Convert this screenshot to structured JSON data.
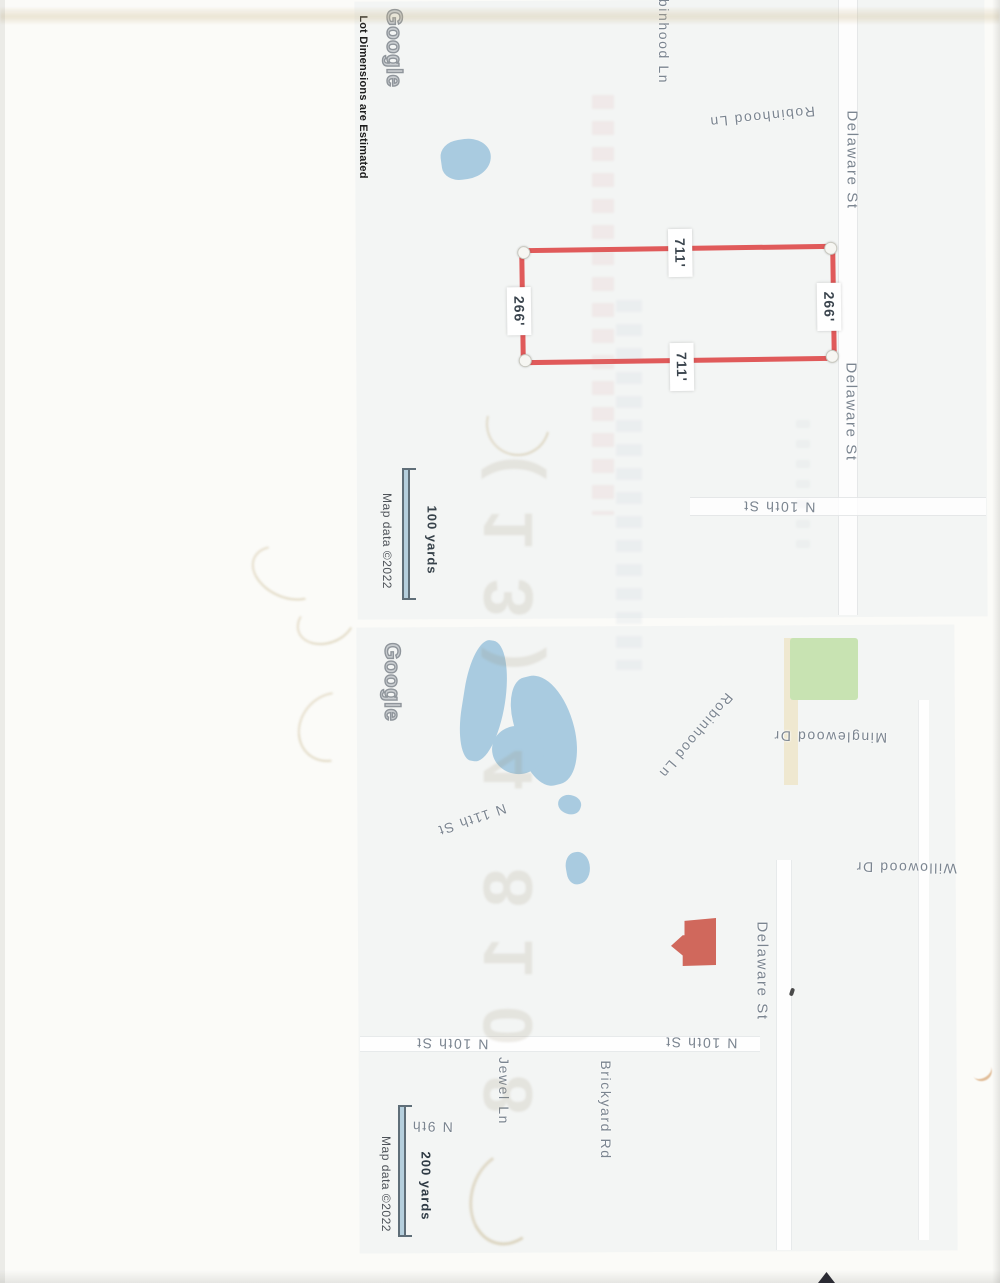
{
  "disclaimer": "Lot Dimensions are Estimated",
  "watermark": "Google",
  "attribution": "Map data ©2022",
  "map1": {
    "scale": "100 yards",
    "lot": {
      "top": "711'",
      "bottom": "711'",
      "left": "266'",
      "right": "266'"
    },
    "labels": {
      "robinhood_top": "Robinhood Ln",
      "robinhood": "Robinhood Ln",
      "delaware_n": "Delaware St",
      "delaware_s": "Delaware St",
      "n10th": "N 10th St"
    }
  },
  "map2": {
    "scale": "200 yards",
    "labels": {
      "robinhood": "Robinhood Ln",
      "minglewood": "Minglewood Dr",
      "willowood": "Willowood Dr",
      "n11th": "N 11th St",
      "delaware": "Delaware St",
      "n10th_w": "N 10th St",
      "n10th_e": "N 10th St",
      "jewel": "Jewel Ln",
      "brickyard": "Brickyard Rd",
      "n9th": "N 9th"
    }
  },
  "colors": {
    "lot_line": "#e05a5a",
    "water": "#a9cbe0",
    "park": "#c8e3b2",
    "house_icon": "#d0685c",
    "scale_bar": "#b5cfdd"
  },
  "artifacts": {
    "showthrough_glyphs": "(13) 4 8108"
  }
}
